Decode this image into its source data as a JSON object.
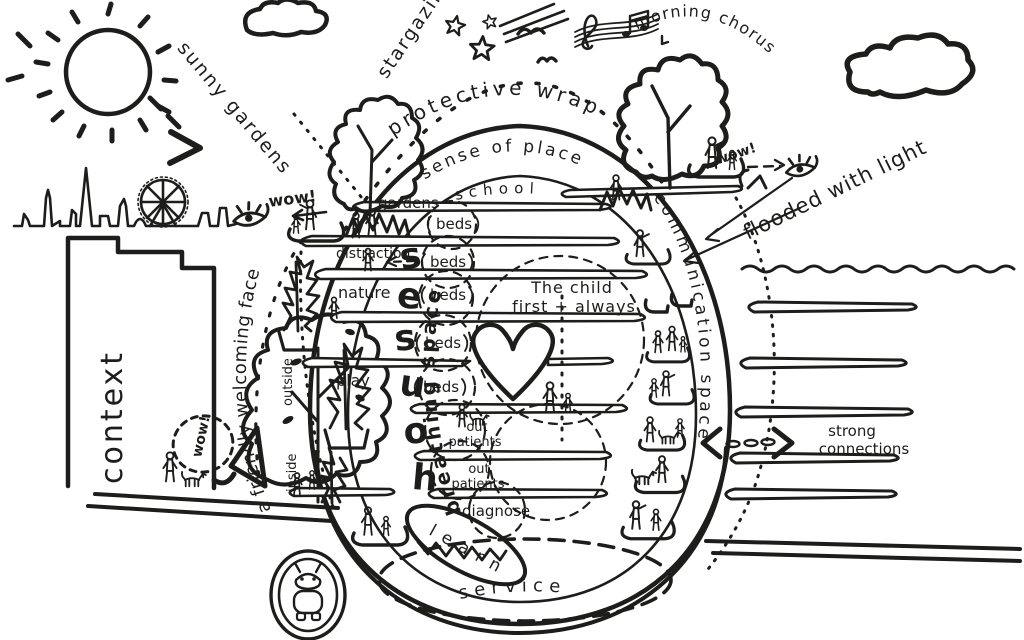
{
  "colors": {
    "ink": "#1d1d1b",
    "paper": "#ffffff"
  },
  "sky": {
    "stargazing": "stargazing",
    "morning_chorus": "morning chorus",
    "sunny_gardens": "sunny gardens"
  },
  "wrap": {
    "protective_wrap": "protective wrap",
    "sense_of_place": "sense of place",
    "flooded_with_light": "flooded with light",
    "wow_roof": "wow!"
  },
  "context_zone": {
    "context": "context",
    "wow_skyline": "wow!",
    "wow_path": "wow!"
  },
  "approach": {
    "welcoming_face": "a friendly welcoming face",
    "outside": "outside",
    "inside": "inside",
    "breathing_space": "breathing space",
    "distraction": "distraction",
    "nature": "nature",
    "play": "play"
  },
  "building": {
    "school": "school",
    "gardens": "gardens",
    "houses_letters": [
      "s",
      "e",
      "s",
      "u",
      "o",
      "h"
    ],
    "beds": [
      "beds",
      "beds",
      "beds",
      "beds",
      "beds"
    ],
    "motto": [
      "The child",
      "first + always"
    ],
    "out_patients_lines": [
      "out",
      "patients"
    ],
    "diagnose": "diagnose",
    "learn": "learn",
    "service": "service"
  },
  "connections": {
    "communication_space": "communication space",
    "strong_connections": [
      "strong",
      "connections"
    ]
  },
  "icons": [
    "sun-icon",
    "cloud-icon",
    "star-icon",
    "shooting-star-icon",
    "bird-icon",
    "music-notes-icon",
    "london-skyline-icon",
    "london-eye-icon",
    "eye-icon",
    "tree-icon",
    "shrub-icon",
    "person-icon",
    "dog-icon",
    "heart-icon",
    "arrow-icon",
    "robot-mascot-icon"
  ]
}
